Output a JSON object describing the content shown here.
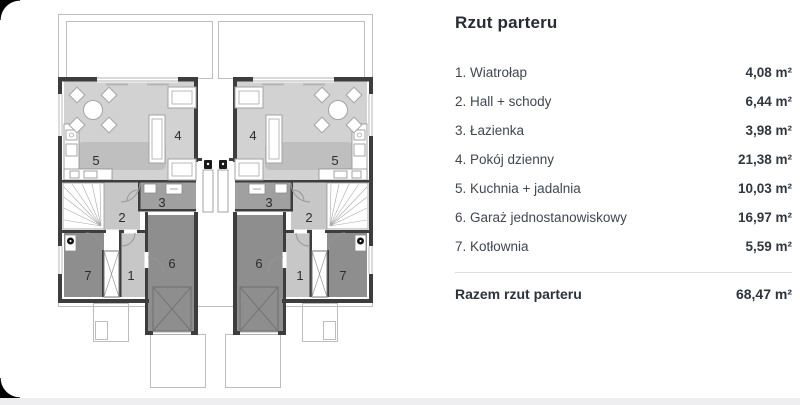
{
  "panel": {
    "title": "Rzut parteru",
    "items": [
      {
        "label": "1. Wiatrołap",
        "area": "4,08 m²"
      },
      {
        "label": "2. Hall + schody",
        "area": "6,44 m²"
      },
      {
        "label": "3. Łazienka",
        "area": "3,98 m²"
      },
      {
        "label": "4. Pokój dzienny",
        "area": "21,38 m²"
      },
      {
        "label": "5. Kuchnia + jadalnia",
        "area": "10,03 m²"
      },
      {
        "label": "6. Garaż jednostanowiskowy",
        "area": "16,97 m²"
      },
      {
        "label": "7. Kotłownia",
        "area": "5,59 m²"
      }
    ],
    "total_label": "Razem rzut parteru",
    "total_area": "68,47 m²"
  },
  "plan": {
    "room_numbers": {
      "n1": "1",
      "n2": "2",
      "n3": "3",
      "n4": "4",
      "n5": "5",
      "n6": "6",
      "n7": "7"
    }
  },
  "colors": {
    "title_text": "#262b36",
    "list_text": "#414653",
    "value_text": "#31363f",
    "plan_living_fill": "#d2d2d2",
    "plan_hall_fill": "#c7c7c7",
    "plan_bath_fill": "#a0a0a0",
    "plan_dark_room_fill": "#8e8e8e",
    "plan_wall": "#3d3d3d",
    "divider": "#dddde0",
    "bottom_strip": "#eeeef0",
    "corner_black": "#000000"
  }
}
